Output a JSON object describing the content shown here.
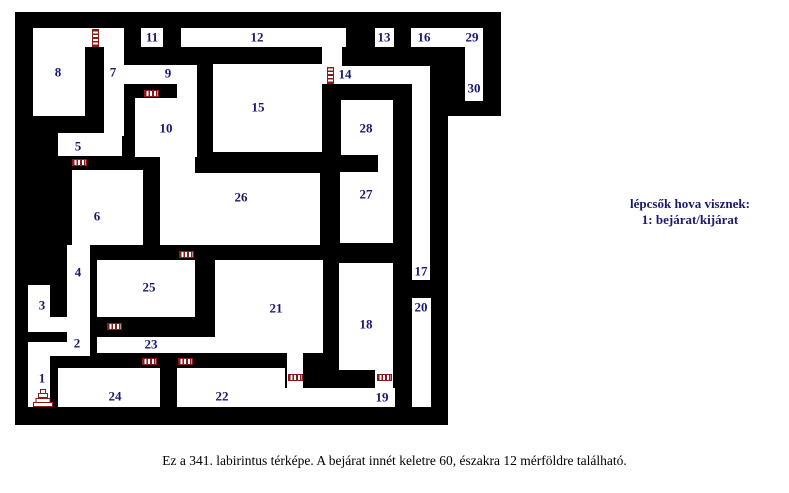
{
  "maze": {
    "wall_color": "#000000",
    "room_color": "#ffffff",
    "label_color": "#191970",
    "ladder_color": "#8B1A1A",
    "black_blocks": [
      {
        "x": 15,
        "y": 12,
        "w": 486,
        "h": 104
      },
      {
        "x": 15,
        "y": 12,
        "w": 433,
        "h": 413
      }
    ],
    "white_areas": [
      {
        "x": 33,
        "y": 28,
        "w": 52,
        "h": 88
      },
      {
        "x": 85,
        "y": 28,
        "w": 39,
        "h": 19
      },
      {
        "x": 104,
        "y": 28,
        "w": 20,
        "h": 108
      },
      {
        "x": 141,
        "y": 28,
        "w": 22,
        "h": 19
      },
      {
        "x": 181,
        "y": 28,
        "w": 165,
        "h": 19
      },
      {
        "x": 322,
        "y": 45,
        "w": 20,
        "h": 23
      },
      {
        "x": 104,
        "y": 65,
        "w": 93,
        "h": 19
      },
      {
        "x": 177,
        "y": 65,
        "w": 20,
        "h": 33
      },
      {
        "x": 135,
        "y": 98,
        "w": 62,
        "h": 59
      },
      {
        "x": 160,
        "y": 152,
        "w": 35,
        "h": 22
      },
      {
        "x": 213,
        "y": 64,
        "w": 109,
        "h": 88
      },
      {
        "x": 316,
        "y": 66,
        "w": 114,
        "h": 18
      },
      {
        "x": 375,
        "y": 28,
        "w": 19,
        "h": 19
      },
      {
        "x": 411,
        "y": 28,
        "w": 72,
        "h": 19
      },
      {
        "x": 465,
        "y": 47,
        "w": 18,
        "h": 54
      },
      {
        "x": 341,
        "y": 100,
        "w": 52,
        "h": 55
      },
      {
        "x": 378,
        "y": 150,
        "w": 15,
        "h": 25
      },
      {
        "x": 340,
        "y": 172,
        "w": 53,
        "h": 71
      },
      {
        "x": 160,
        "y": 173,
        "w": 160,
        "h": 72
      },
      {
        "x": 58,
        "y": 133,
        "w": 64,
        "h": 23
      },
      {
        "x": 72,
        "y": 170,
        "w": 71,
        "h": 75
      },
      {
        "x": 67,
        "y": 245,
        "w": 23,
        "h": 111
      },
      {
        "x": 28,
        "y": 285,
        "w": 22,
        "h": 47
      },
      {
        "x": 28,
        "y": 317,
        "w": 62,
        "h": 15
      },
      {
        "x": 28,
        "y": 342,
        "w": 62,
        "h": 14
      },
      {
        "x": 28,
        "y": 342,
        "w": 22,
        "h": 65
      },
      {
        "x": 97,
        "y": 260,
        "w": 98,
        "h": 57
      },
      {
        "x": 97,
        "y": 337,
        "w": 226,
        "h": 16
      },
      {
        "x": 215,
        "y": 260,
        "w": 108,
        "h": 93
      },
      {
        "x": 58,
        "y": 368,
        "w": 102,
        "h": 39
      },
      {
        "x": 177,
        "y": 368,
        "w": 108,
        "h": 39
      },
      {
        "x": 287,
        "y": 353,
        "w": 16,
        "h": 54
      },
      {
        "x": 268,
        "y": 388,
        "w": 127,
        "h": 19
      },
      {
        "x": 375,
        "y": 370,
        "w": 18,
        "h": 37
      },
      {
        "x": 339,
        "y": 263,
        "w": 54,
        "h": 107
      },
      {
        "x": 412,
        "y": 84,
        "w": 18,
        "h": 196
      },
      {
        "x": 412,
        "y": 298,
        "w": 19,
        "h": 109
      }
    ],
    "rooms": [
      {
        "id": "1",
        "x": 42,
        "y": 378
      },
      {
        "id": "2",
        "x": 77,
        "y": 343
      },
      {
        "id": "3",
        "x": 42,
        "y": 305
      },
      {
        "id": "4",
        "x": 78,
        "y": 272
      },
      {
        "id": "5",
        "x": 78,
        "y": 146
      },
      {
        "id": "6",
        "x": 97,
        "y": 216
      },
      {
        "id": "7",
        "x": 113,
        "y": 72
      },
      {
        "id": "8",
        "x": 58,
        "y": 72
      },
      {
        "id": "9",
        "x": 168,
        "y": 73
      },
      {
        "id": "10",
        "x": 166,
        "y": 128
      },
      {
        "id": "11",
        "x": 152,
        "y": 37
      },
      {
        "id": "12",
        "x": 257,
        "y": 37
      },
      {
        "id": "13",
        "x": 384,
        "y": 37
      },
      {
        "id": "14",
        "x": 345,
        "y": 74
      },
      {
        "id": "15",
        "x": 258,
        "y": 107
      },
      {
        "id": "16",
        "x": 424,
        "y": 37
      },
      {
        "id": "17",
        "x": 421,
        "y": 271
      },
      {
        "id": "18",
        "x": 366,
        "y": 324
      },
      {
        "id": "19",
        "x": 382,
        "y": 397
      },
      {
        "id": "20",
        "x": 421,
        "y": 307
      },
      {
        "id": "21",
        "x": 276,
        "y": 308
      },
      {
        "id": "22",
        "x": 222,
        "y": 396
      },
      {
        "id": "23",
        "x": 151,
        "y": 344
      },
      {
        "id": "24",
        "x": 115,
        "y": 396
      },
      {
        "id": "25",
        "x": 149,
        "y": 287
      },
      {
        "id": "26",
        "x": 241,
        "y": 197
      },
      {
        "id": "27",
        "x": 366,
        "y": 194
      },
      {
        "id": "28",
        "x": 366,
        "y": 128
      },
      {
        "id": "29",
        "x": 472,
        "y": 37
      },
      {
        "id": "30",
        "x": 474,
        "y": 88
      }
    ],
    "ladders": [
      {
        "x": 92,
        "y": 29,
        "w": 7,
        "h": 18,
        "dir": "v"
      },
      {
        "x": 144,
        "y": 90,
        "w": 15,
        "h": 7,
        "dir": "h"
      },
      {
        "x": 327,
        "y": 67,
        "w": 7,
        "h": 17,
        "dir": "v"
      },
      {
        "x": 72,
        "y": 159,
        "w": 15,
        "h": 7,
        "dir": "h"
      },
      {
        "x": 179,
        "y": 251,
        "w": 15,
        "h": 7,
        "dir": "h"
      },
      {
        "x": 107,
        "y": 323,
        "w": 15,
        "h": 7,
        "dir": "h"
      },
      {
        "x": 142,
        "y": 358,
        "w": 15,
        "h": 7,
        "dir": "h"
      },
      {
        "x": 178,
        "y": 358,
        "w": 15,
        "h": 7,
        "dir": "h"
      },
      {
        "x": 288,
        "y": 374,
        "w": 15,
        "h": 7,
        "dir": "h"
      },
      {
        "x": 377,
        "y": 374,
        "w": 15,
        "h": 7,
        "dir": "h"
      }
    ],
    "stairs": {
      "x": 33,
      "y": 388,
      "w": 20,
      "h": 19,
      "step_widths": [
        20,
        15,
        10,
        6
      ]
    }
  },
  "legend": {
    "title": "lépcsők hova visznek:",
    "entry": "1: bejárat/kijárat"
  },
  "caption": "Ez a 341. labirintus térképe. A bejárat innét keletre 60, északra 12 mérföldre található."
}
